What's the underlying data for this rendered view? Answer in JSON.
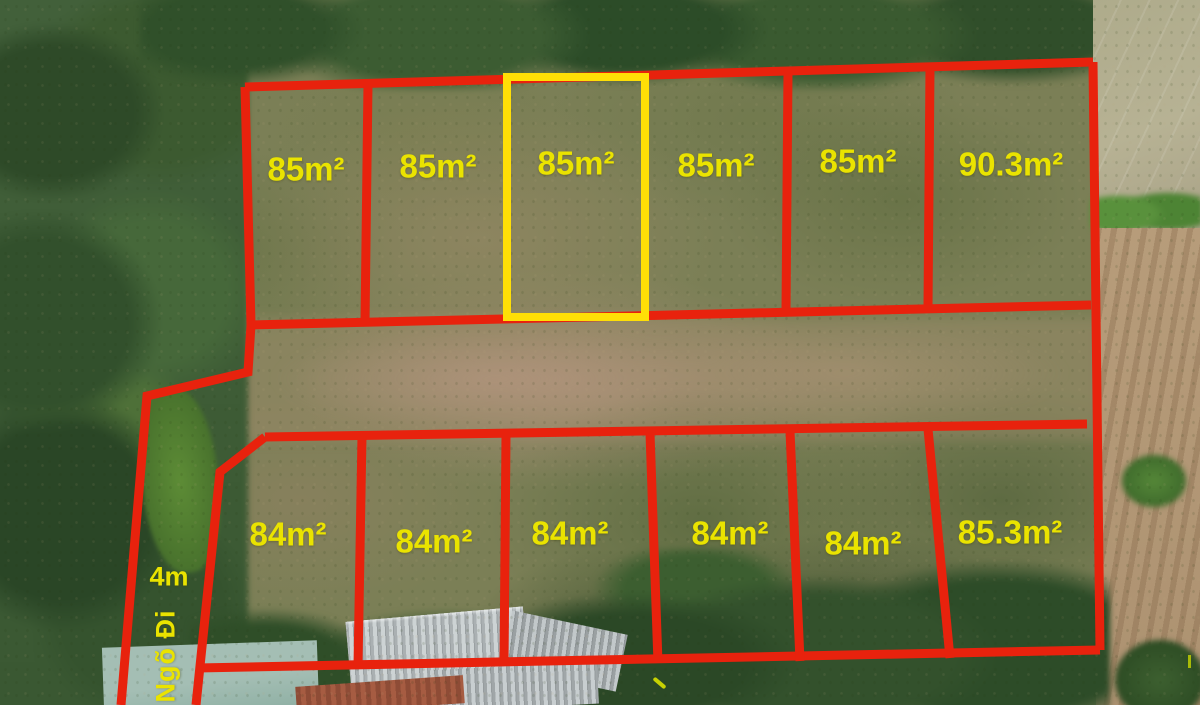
{
  "colors": {
    "boundary_red": "#e8220d",
    "highlight_yellow": "#ffdf06",
    "label_yellow": "#eae300"
  },
  "plots": {
    "top_row": [
      {
        "area_label": "85m²",
        "highlighted": false
      },
      {
        "area_label": "85m²",
        "highlighted": false
      },
      {
        "area_label": "85m²",
        "highlighted": true
      },
      {
        "area_label": "85m²",
        "highlighted": false
      },
      {
        "area_label": "85m²",
        "highlighted": false
      },
      {
        "area_label": "90.3m²",
        "highlighted": false
      }
    ],
    "bottom_row": [
      {
        "area_label": "84m²",
        "highlighted": false
      },
      {
        "area_label": "84m²",
        "highlighted": false
      },
      {
        "area_label": "84m²",
        "highlighted": false
      },
      {
        "area_label": "84m²",
        "highlighted": false
      },
      {
        "area_label": "84m²",
        "highlighted": false
      },
      {
        "area_label": "85.3m²",
        "highlighted": false
      }
    ]
  },
  "road": {
    "width_label": "4m",
    "name_label": "Ngõ Đi"
  }
}
